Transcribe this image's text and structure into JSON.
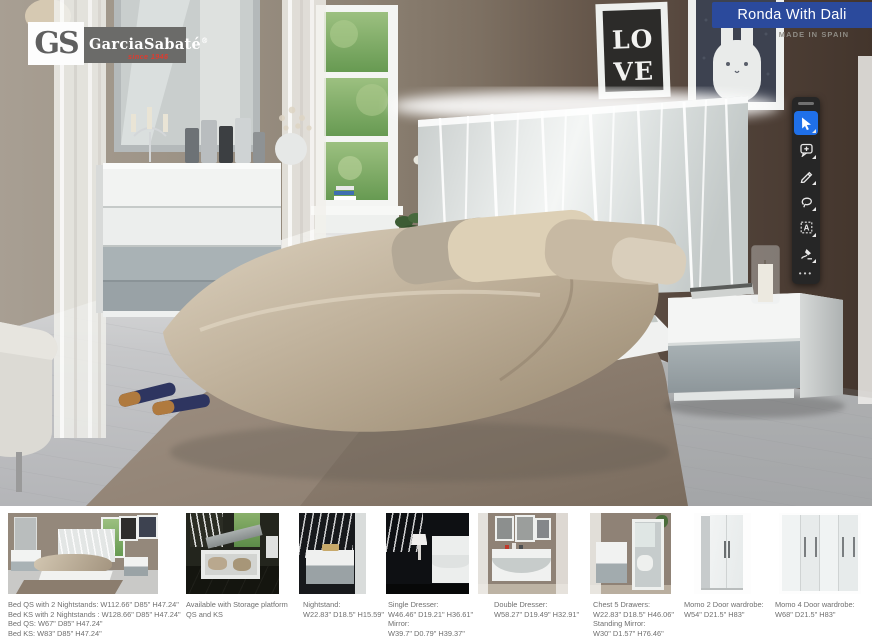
{
  "header": {
    "logo": {
      "gs": "GS",
      "brand": "GarciaSabaté",
      "registered": "®",
      "since": "since 1946",
      "accent_color": "#e03a2e"
    },
    "banner": {
      "title": "Ronda With Dali",
      "color": "#2b4a9c"
    },
    "origin_label": "MADE IN SPAIN"
  },
  "scene": {
    "love_poster": {
      "line1": "LO",
      "line2": "VE"
    }
  },
  "toolbar": {
    "background": "#262626",
    "selected_color": "#1f70e9",
    "tools": [
      "select-cursor",
      "add-comment",
      "pen",
      "lasso",
      "text-select",
      "stamp"
    ],
    "text_tool_glyph": "A",
    "more_label": "•••"
  },
  "products": [
    {
      "name": "bed",
      "lines": [
        "Bed QS with 2 Nightstands: W112.66\" D85\" H47.24\"",
        "Bed KS with 2 Nightstands : W128.66\" D85\" H47.24\"",
        "Bed QS: W67\" D85\" H47.24\"",
        "Bed KS: W83\" D85\" H47.24\""
      ]
    },
    {
      "name": "storage-platform-bed",
      "lines": [
        "Available with Storage platform",
        "QS and KS"
      ]
    },
    {
      "name": "nightstand",
      "lines": [
        "Nightstand:",
        "W22.83\" D18.5\" H15.59\""
      ]
    },
    {
      "name": "single-dresser-mirror",
      "lines": [
        "Single Dresser:",
        "W46.46\" D19.21\" H36.61\"",
        "Mirror:",
        "W39.7\" D0.79\" H39.37\""
      ]
    },
    {
      "name": "double-dresser",
      "lines": [
        "Double Dresser:",
        "W58.27\" D19.49\" H32.91\""
      ]
    },
    {
      "name": "chest-standing-mirror",
      "lines": [
        "Chest 5 Drawers:",
        "W22.83\" D18.5\" H46.06\"",
        "Standing Mirror:",
        "W30\" D1.57\" H76.46\""
      ]
    },
    {
      "name": "momo-2-door-wardrobe",
      "lines": [
        "Momo 2 Door wardrobe:",
        "W54\" D21.5\" H83\""
      ]
    },
    {
      "name": "momo-4-door-wardrobe",
      "lines": [
        "Momo 4 Door wardrobe:",
        "W68\" D21.5\" H83\""
      ]
    }
  ]
}
